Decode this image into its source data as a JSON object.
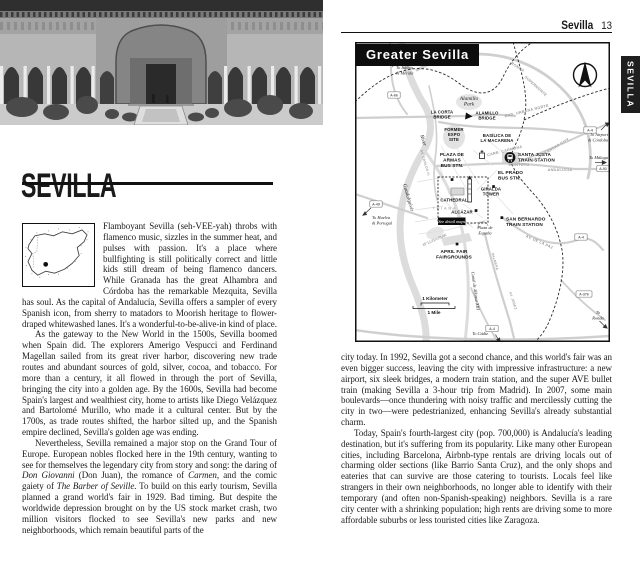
{
  "header": {
    "section": "Sevilla",
    "page_number": "13"
  },
  "tab": {
    "label": "SEVILLA"
  },
  "title": {
    "text": "SEVILLA"
  },
  "map": {
    "title": "Greater Sevilla",
    "scale": {
      "km": "1 Kilometer",
      "mile": "1 Mile"
    },
    "labels": [
      {
        "t": "To Itálica\n& Mérida",
        "x": 41,
        "y": 27,
        "c": "m-it",
        "a": "s",
        "lh": 5.3
      },
      {
        "t": "Alamillo\nPark",
        "x": 114,
        "y": 58,
        "c": "m-it m-it-lg",
        "lh": 5.6
      },
      {
        "t": "LA CORTA\nBRIDGE",
        "x": 87,
        "y": 71.5,
        "c": "m-poi",
        "lh": 4.9
      },
      {
        "t": "ALAMILLO\nBRIDGE",
        "x": 132,
        "y": 72.5,
        "c": "m-poi",
        "lh": 4.9
      },
      {
        "t": "FORMER\nEXPO\nSITE",
        "x": 99,
        "y": 89,
        "c": "m-poi",
        "lh": 4.9
      },
      {
        "t": "BASÍLICA DE\nLA MACARENA",
        "x": 142,
        "y": 95,
        "c": "m-poi",
        "lh": 5
      },
      {
        "t": "PLAZA DE\nARMAS\nBUS STN.",
        "x": 97,
        "y": 114,
        "c": "m-poi m-poi-lg",
        "lh": 5.4
      },
      {
        "t": "SANTA JUSTA\nTRAIN STATION",
        "x": 163,
        "y": 114,
        "c": "m-poi m-poi-lg",
        "a": "s",
        "lh": 5.4
      },
      {
        "t": "EL PRADO\nBUS STN.",
        "x": 143,
        "y": 132,
        "c": "m-poi m-poi-lg",
        "a": "s",
        "lh": 5.4
      },
      {
        "t": "SAN BERNARDO\nTRAIN STATION",
        "x": 151,
        "y": 178.5,
        "c": "m-poi m-poi-lg",
        "a": "s",
        "lh": 5.4
      },
      {
        "t": "GIRALDA\nTOWER",
        "x": 136,
        "y": 148.5,
        "c": "m-poi",
        "lh": 4.9
      },
      {
        "t": "CATHEDRAL",
        "x": 99,
        "y": 159.5,
        "c": "m-poi"
      },
      {
        "t": "ALCÁZAR",
        "x": 107,
        "y": 171.5,
        "c": "m-poi"
      },
      {
        "t": "TRIANA",
        "x": 90,
        "y": 167.5,
        "c": "m-area"
      },
      {
        "t": "See detail maps",
        "x": 96.7,
        "y": 180.8,
        "c": "m-detail"
      },
      {
        "t": "Plaza de\nEspaña",
        "x": 130,
        "y": 187,
        "c": "m-it",
        "lh": 5.3
      },
      {
        "t": "Mª LUISA PARK",
        "x": 80,
        "y": 199,
        "c": "m-it m-it-sm",
        "r": -24
      },
      {
        "t": "APRIL FAIR\nFAIRGROUNDS",
        "x": 99,
        "y": 211,
        "c": "m-poi m-poi-lg",
        "lh": 5.4
      },
      {
        "t": "River",
        "x": 67,
        "y": 99,
        "c": "m-it m-it-lg",
        "r": 72
      },
      {
        "t": "Guadalquivir",
        "x": 52,
        "y": 156,
        "c": "m-it m-it-lg",
        "r": 74
      },
      {
        "t": "Canal de Alfonso XIII",
        "x": 119,
        "y": 249,
        "c": "m-it",
        "r": 82
      },
      {
        "t": "RONDA",
        "x": 162,
        "y": 26,
        "c": "m-road",
        "r": 33
      },
      {
        "t": "SUPERNORTE",
        "x": 180,
        "y": 45,
        "c": "m-road",
        "r": 42
      },
      {
        "t": "RND. URBANA NORTE",
        "x": 172,
        "y": 70,
        "c": "m-road",
        "r": -14
      },
      {
        "t": "CARR. CARMONA",
        "x": 150,
        "y": 110,
        "c": "m-road",
        "r": -14
      },
      {
        "t": "AV. DE KANSAS CITY",
        "x": 196,
        "y": 109,
        "c": "m-road",
        "r": -31
      },
      {
        "t": "MONTOTO",
        "x": 164,
        "y": 124,
        "c": "m-road"
      },
      {
        "t": "ANDALUCÍA",
        "x": 205,
        "y": 129,
        "c": "m-road"
      },
      {
        "t": "AV. DE LA PAZ",
        "x": 184,
        "y": 201,
        "c": "m-road",
        "r": 24
      },
      {
        "t": "PALMERA",
        "x": 139,
        "y": 220,
        "c": "m-road m-road-sm",
        "r": 74
      },
      {
        "t": "AV. JEREZ",
        "x": 157,
        "y": 259,
        "c": "m-road m-road-sm",
        "r": 72
      },
      {
        "t": "AV. CARLOS III",
        "x": 69,
        "y": 121,
        "c": "m-road m-road-sm",
        "r": 74
      },
      {
        "t": "To Airport\n& Córdoba",
        "x": 253,
        "y": 94,
        "c": "m-it",
        "a": "e",
        "lh": 5.3
      },
      {
        "t": "To Málaga",
        "x": 253,
        "y": 117,
        "c": "m-it",
        "a": "e"
      },
      {
        "t": "To\nRonda",
        "x": 243,
        "y": 272,
        "c": "m-it",
        "lh": 5.3
      },
      {
        "t": "To Cádiz",
        "x": 125,
        "y": 293,
        "c": "m-it"
      },
      {
        "t": "To Huelva\n& Portugal",
        "x": 17,
        "y": 177,
        "c": "m-it",
        "a": "s",
        "lh": 5.3
      },
      {
        "t": "1 Kilometer",
        "x": 80,
        "y": 258,
        "c": "m-scale"
      },
      {
        "t": "1 Mile",
        "x": 79,
        "y": 272,
        "c": "m-scale"
      }
    ],
    "shields": [
      {
        "t": "A-66",
        "x": 39,
        "y": 53
      },
      {
        "t": "A-49",
        "x": 21,
        "y": 162
      },
      {
        "t": "A-4",
        "x": 235,
        "y": 88
      },
      {
        "t": "A-92",
        "x": 248,
        "y": 126.5
      },
      {
        "t": "A-4",
        "x": 226,
        "y": 195
      },
      {
        "t": "A-376",
        "x": 229,
        "y": 252
      },
      {
        "t": "A-4",
        "x": 137,
        "y": 286.5
      }
    ]
  },
  "left": {
    "paragraphs": [
      [
        {
          "t": "Flamboyant Sevilla (seh-VEE-yah) throbs with flamenco music, sizzles in the summer heat, and pulses with passion. It's a place where bullfighting is still politically correct and little kids still dream of being flamenco dancers. While Granada has the great Alhambra and Córdoba has the remarkable Mezquita, Sevilla has soul. As the capital of Andalucía, Sevilla offers a sampler of every Spanish icon, from sherry to matadors to Moorish heritage to flower-draped whitewashed lanes. It's a wonderful-to-be-alive-in kind of place."
        }
      ],
      [
        {
          "t": "As the gateway to the New World in the 1500s, Sevilla boomed when Spain did. The explorers Amerigo Vespucci and Ferdinand Magellan sailed from its great river harbor, discovering new trade routes and abundant sources of gold, silver, cocoa, and tobacco. For more than a century, it all flowed in through the port of Sevilla, bringing the city into a golden age. By the 1600s, Sevilla had become Spain's largest and wealthiest city, home to artists like Diego Velázquez and Bartolomé Murillo, who made it a cultural center. But by the 1700s, as trade routes shifted, the harbor silted up, and the Spanish empire declined, Sevilla's golden age was ending."
        }
      ],
      [
        {
          "t": "Nevertheless, Sevilla remained a major stop on the Grand Tour of Europe. European nobles flocked here in the 19th century, wanting to see for themselves the legendary city from story and song: the daring of "
        },
        {
          "t": "Don Giovanni",
          "i": true
        },
        {
          "t": " (Don Juan), the romance of "
        },
        {
          "t": "Carmen",
          "i": true
        },
        {
          "t": ", and the comic gaiety of "
        },
        {
          "t": "The Barber of Seville",
          "i": true
        },
        {
          "t": ". To build on this early tourism, Sevilla planned a grand world's fair in 1929. Bad timing. But despite the worldwide depression brought on by the US stock market crash, two million visitors flocked to see Sevilla's new parks and new neighborhoods, which remain beautiful parts of the"
        }
      ]
    ]
  },
  "right": {
    "paragraphs": [
      [
        {
          "t": "city today. In 1992, Sevilla got a second chance, and this world's fair was an even bigger success, leaving the city with impressive infrastructure: a new airport, six sleek bridges, a modern train station, and the super AVE bullet train (making Sevilla a 3-hour trip from Madrid). In 2007, some main boulevards—once thundering with noisy traffic and mercilessly cutting the city in two—were pedestrianized, enhancing Sevilla's already substantial charm."
        }
      ],
      [
        {
          "t": "Today, Spain's fourth-largest city (pop. 700,000) is Andalucía's leading destination, but it's suffering from its popularity. Like many other European cities, including Barcelona, Airbnb-type rentals are driving locals out of charming older sections (like Barrio Santa Cruz), and the only shops and eateries that can survive are those catering to tourists. Locals feel like strangers in their own neighborhoods, no longer able to identify with their temporary (and often non-Spanish-speaking) neighbors. Sevilla is a rare city center with a shrinking population; high rents are driving some to more affordable suburbs or less touristed cities like Zaragoza."
        }
      ]
    ]
  }
}
